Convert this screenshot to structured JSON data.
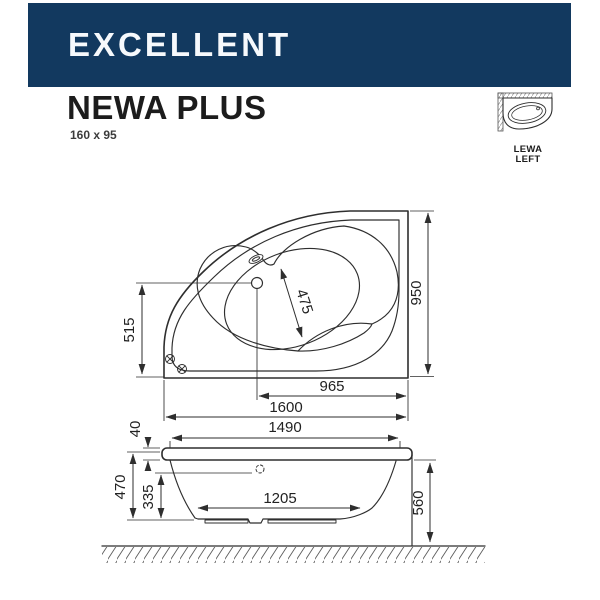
{
  "header": {
    "brand": "EXCELLENT",
    "product_name": "NEWA PLUS",
    "product_size": "160 x 95",
    "banner_color": "#12395f"
  },
  "orientation_badge": {
    "line1": "LEWA",
    "line2": "LEFT"
  },
  "top_view": {
    "total_length": "1600",
    "drain_to_edge": "965",
    "total_width": "950",
    "left_edge_height": "515",
    "seat_diagonal": "475"
  },
  "section_view": {
    "rim_height": "40",
    "top_inner_length": "1490",
    "shell_depth": "470",
    "inner_depth": "335",
    "bottom_length": "1205",
    "installed_height": "560"
  },
  "colors": {
    "banner": "#12395f",
    "line": "#2e2e2e",
    "text": "#1f1f1f"
  }
}
